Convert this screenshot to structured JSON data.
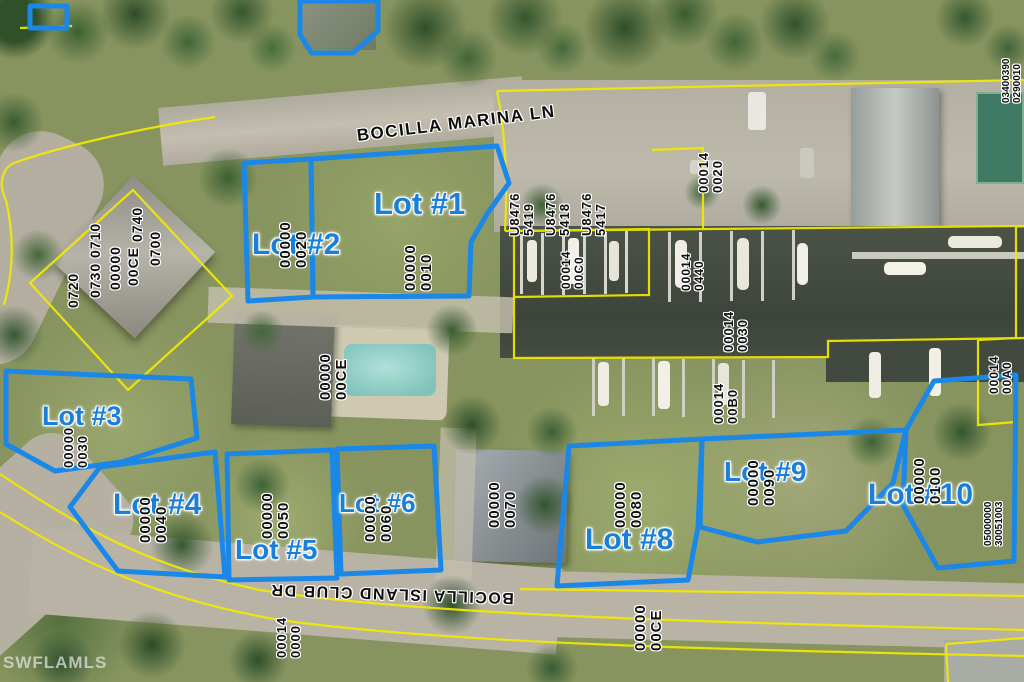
{
  "watermark": "SWFLAMLS",
  "streets": {
    "marina": "BOCILLA MARINA LN",
    "club": "BOCILLA ISLAND CLUB DR"
  },
  "lots": [
    {
      "label": "Lot #1"
    },
    {
      "label": "Lot #2"
    },
    {
      "label": "Lot #3"
    },
    {
      "label": "Lot #4"
    },
    {
      "label": "Lot #5"
    },
    {
      "label": "Lot #6"
    },
    {
      "label": "Lot #8"
    },
    {
      "label": "Lot #9"
    },
    {
      "label": "Lot #10"
    }
  ],
  "parcels": [
    {
      "col1": "00000",
      "col2": "0010"
    },
    {
      "col1": "00000",
      "col2": "0020"
    },
    {
      "col1": "00000",
      "col2": "0030"
    },
    {
      "col1": "00000",
      "col2": "0040"
    },
    {
      "col1": "00000",
      "col2": "0050"
    },
    {
      "col1": "00000",
      "col2": "0060"
    },
    {
      "col1": "00000",
      "col2": "0070"
    },
    {
      "col1": "00000",
      "col2": "0080"
    },
    {
      "col1": "00000",
      "col2": "0090"
    },
    {
      "col1": "00000",
      "col2": "0100"
    },
    {
      "col1": "00000",
      "col2": "00CE"
    },
    {
      "col1": "U8476",
      "col2": "5419"
    },
    {
      "col1": "U8476",
      "col2": "5418"
    },
    {
      "col1": "U8476",
      "col2": "5417"
    },
    {
      "col1": "00014",
      "col2": "0020"
    },
    {
      "col1": "00014",
      "col2": "00C0"
    },
    {
      "col1": "00014",
      "col2": "0440"
    },
    {
      "col1": "00014",
      "col2": "0030"
    },
    {
      "col1": "00014",
      "col2": "00B0"
    },
    {
      "col1": "00014",
      "col2": "00A0"
    },
    {
      "col1": "05000000",
      "col2": "30051003"
    },
    {
      "col1": "00014",
      "col2": "0000"
    },
    {
      "col1": "00000",
      "col2": "00CE"
    },
    {
      "col1": "03400390",
      "col2": "0290010"
    }
  ],
  "topleft_block": {
    "cols": [
      "0720",
      "0730 0710",
      "00000",
      "00CE",
      "0740",
      "0700"
    ]
  },
  "colors": {
    "lot_outline": "#1b87e6",
    "lot_label": "#1a7fd9",
    "parcel_line": "#f2ea00",
    "water": "#434b41"
  }
}
